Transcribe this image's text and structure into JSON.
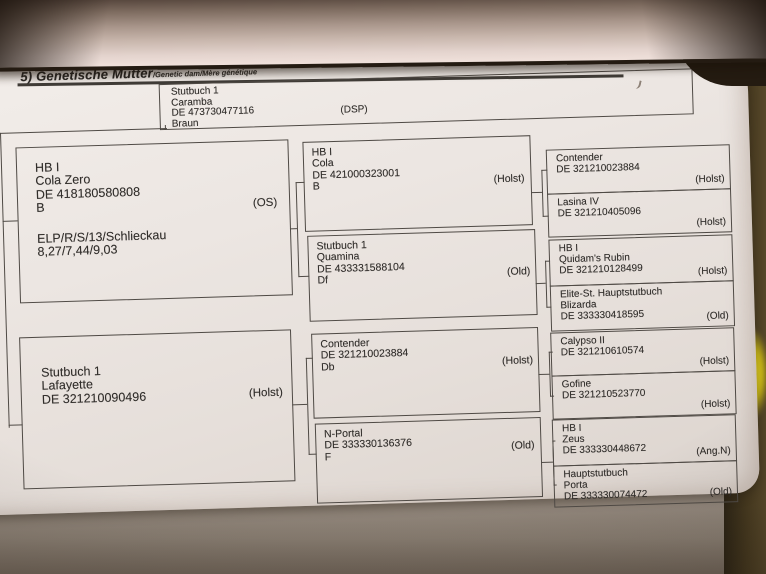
{
  "document": {
    "header": {
      "label": "5) Genetische Mutter",
      "sublabel": "/Genetic dam/Mère génétique"
    },
    "subject": {
      "lines": [
        "Stutbuch 1",
        "Caramba",
        "DE 473730477116",
        "Braun"
      ],
      "breed": "(DSP)"
    },
    "gen1": [
      {
        "lines": [
          "HB I",
          "Cola Zero",
          "DE 418180580808",
          "B"
        ],
        "extra": [
          "ELP/R/S/13/Schlieckau",
          "8,27/7,44/9,03"
        ],
        "breed": "(OS)"
      },
      {
        "lines": [
          "Stutbuch 1",
          "Lafayette",
          "DE 321210090496"
        ],
        "breed": "(Holst)"
      }
    ],
    "gen2": [
      {
        "lines": [
          "HB I",
          "Cola",
          "DE 421000323001",
          "B"
        ],
        "breed": "(Holst)"
      },
      {
        "lines": [
          "Stutbuch 1",
          "Quamina",
          "DE 433331588104",
          "Df"
        ],
        "breed": "(Old)"
      },
      {
        "lines": [
          "Contender",
          "DE 321210023884",
          "Db"
        ],
        "breed": "(Holst)"
      },
      {
        "lines": [
          "N-Portal",
          "DE 333330136376",
          "F"
        ],
        "breed": "(Old)"
      }
    ],
    "gen3": [
      {
        "lines": [
          "Contender",
          "DE 321210023884"
        ],
        "breed": "(Holst)"
      },
      {
        "lines": [
          "Lasina IV",
          "DE 321210405096"
        ],
        "breed": "(Holst)"
      },
      {
        "lines": [
          "HB I",
          "Quidam's Rubin",
          "DE 321210128499"
        ],
        "breed": "(Holst)"
      },
      {
        "lines": [
          "Elite-St.  Hauptstutbuch",
          "Blizarda",
          "DE 333330418595"
        ],
        "breed": "(Old)"
      },
      {
        "lines": [
          "Calypso II",
          "DE 321210610574"
        ],
        "breed": "(Holst)"
      },
      {
        "lines": [
          "Gofine",
          "DE 321210523770"
        ],
        "breed": "(Holst)"
      },
      {
        "lines": [
          "HB I",
          "Zeus",
          "DE 333330448672"
        ],
        "breed": "(Ang.N)"
      },
      {
        "lines": [
          "Hauptstutbuch",
          "Porta",
          "DE 333330074472"
        ],
        "breed": "(Old)"
      }
    ],
    "colors": {
      "page": "#ece6e1",
      "ink": "#312e2b",
      "rule": "#4f4a45",
      "backdrop": "#46391f",
      "highlight": "#d2c015",
      "curl": "#c7b5ab"
    }
  }
}
